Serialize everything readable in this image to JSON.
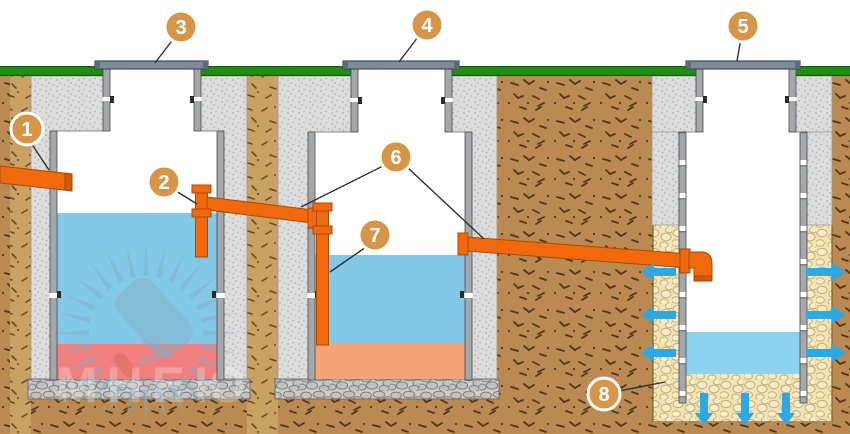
{
  "callouts": [
    {
      "number": "1"
    },
    {
      "number": "2"
    },
    {
      "number": "3"
    },
    {
      "number": "4"
    },
    {
      "number": "5"
    },
    {
      "number": "6"
    },
    {
      "number": "7"
    },
    {
      "number": "8"
    }
  ],
  "watermark": {
    "text": "МНЕЮ"
  },
  "colors": {
    "pipe": "#F2690D",
    "pipe_dark": "#C85808",
    "water": "#82C9E8",
    "well_water": "#8CD2EC",
    "sludge_tank1": "#F17F80",
    "sludge_tank2": "#F5A477",
    "grass": "#1F8E13",
    "soil": "#BA8A52",
    "backfill": "#C9A162",
    "gravel": "#F1E3B4",
    "concrete": "#DCDCDC",
    "wall": "#A5A8AB",
    "lid": "#7E8B98",
    "arrow": "#2CA9E3",
    "callout_fill": "#D69549",
    "leader": "#2F2F2F"
  }
}
